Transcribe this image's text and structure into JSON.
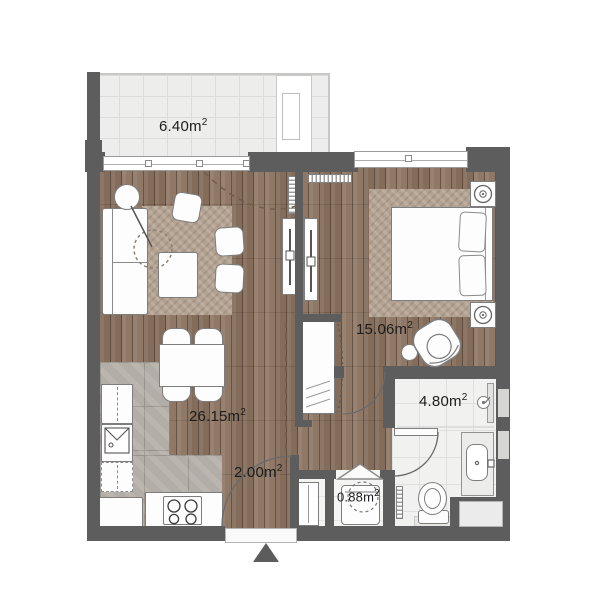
{
  "title": "apartment-floor-plan",
  "rooms": [
    {
      "name": "balcony",
      "area": "6.40m",
      "area_sup": "2"
    },
    {
      "name": "living-kitchen",
      "area": "26.15m",
      "area_sup": "2"
    },
    {
      "name": "hallway",
      "area": "2.00m",
      "area_sup": "2"
    },
    {
      "name": "storage",
      "area": "0.88m",
      "area_sup": "2"
    },
    {
      "name": "bedroom",
      "area": "15.06m",
      "area_sup": "2"
    },
    {
      "name": "bathroom",
      "area": "4.80m",
      "area_sup": "2"
    }
  ],
  "colors": {
    "wall": "#5d5d5d",
    "wood_floor": "#8b7360",
    "balcony_tile": "#ededec",
    "bath_tile": "#f1f1ef",
    "kitchen_marble": "#b2ada6",
    "rug": "#b3a291",
    "label_text": "#1c1c1c"
  }
}
